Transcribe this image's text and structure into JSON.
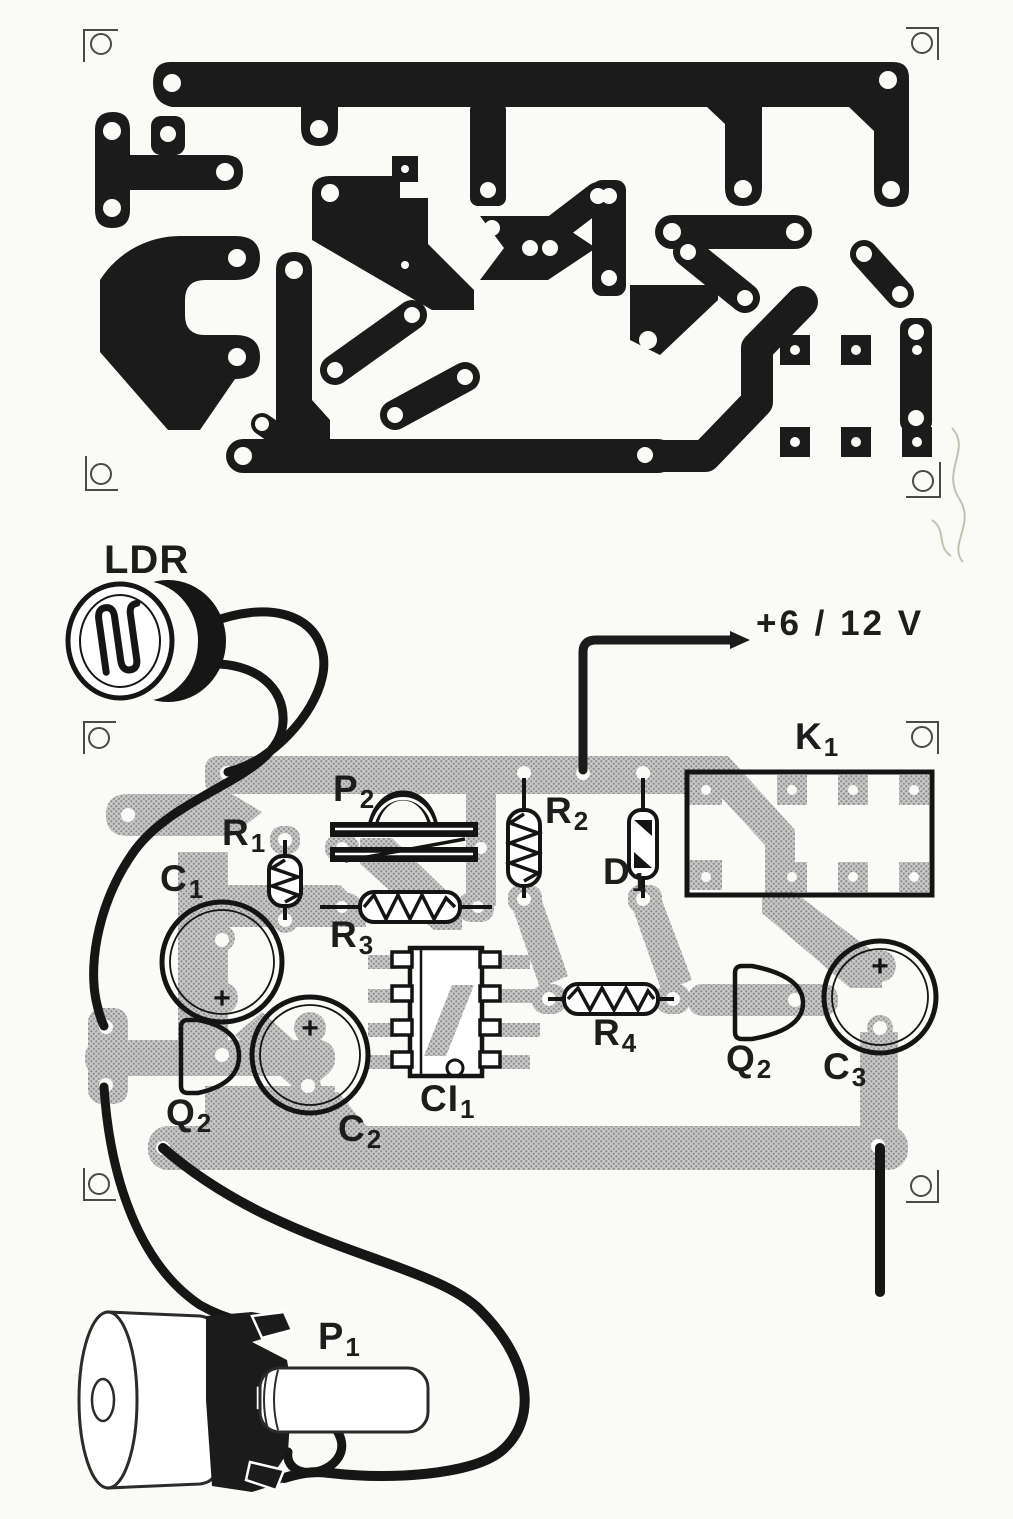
{
  "labels": {
    "ldr": {
      "main": "LDR",
      "sub": ""
    },
    "supply": {
      "main": "+6 / 12 V",
      "sub": ""
    },
    "k1": {
      "main": "K",
      "sub": "1"
    },
    "p2": {
      "main": "P",
      "sub": "2"
    },
    "r1": {
      "main": "R",
      "sub": "1"
    },
    "r2": {
      "main": "R",
      "sub": "2"
    },
    "d1": {
      "main": "D",
      "sub": "1"
    },
    "c1": {
      "main": "C",
      "sub": "1"
    },
    "r3": {
      "main": "R",
      "sub": "3"
    },
    "ci1": {
      "main": "CI",
      "sub": "1"
    },
    "r4": {
      "main": "R",
      "sub": "4"
    },
    "q2_left": {
      "main": "Q",
      "sub": "2"
    },
    "c2": {
      "main": "C",
      "sub": "2"
    },
    "q2_right": {
      "main": "Q",
      "sub": "2"
    },
    "c3": {
      "main": "C",
      "sub": "3"
    },
    "p1": {
      "main": "P",
      "sub": "1"
    }
  },
  "marks": {
    "plus": "+"
  },
  "colors": {
    "ink": "#1b1b1b",
    "trace_gray_base": "#c9c9c9",
    "trace_gray_dot": "#8f8f8f",
    "paper": "#fafaf7"
  }
}
